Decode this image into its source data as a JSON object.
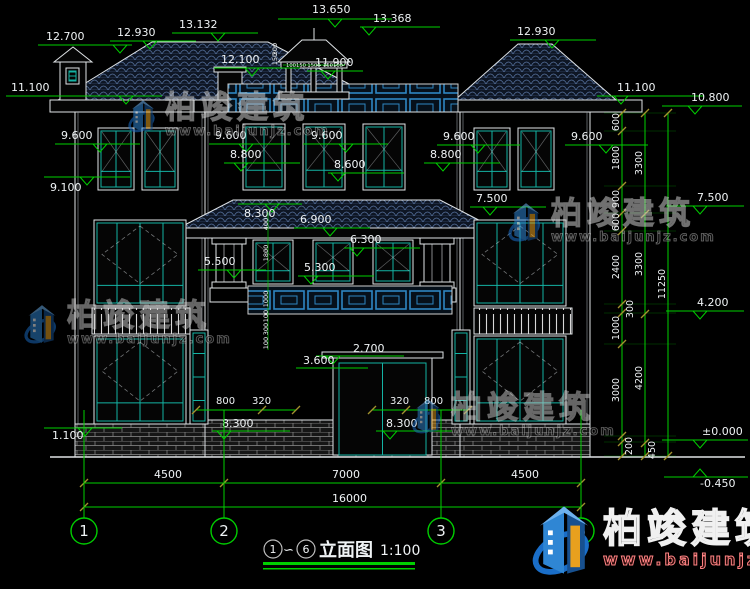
{
  "drawing": {
    "title_bar": {
      "axis_start": "1",
      "tilde": "∽",
      "axis_end": "6",
      "title": "立面图",
      "scale": "1:100"
    },
    "watermark": {
      "brand": "柏竣建筑",
      "url": "www.baijunjz.com"
    },
    "colors": {
      "green": "#00cf00",
      "olive": "#a3922e",
      "text": "#eff3f5",
      "teal": "#14b3a4",
      "blue": "#2e86c1",
      "line": "#dfe3e6",
      "logo_blue": "#1a6ec8",
      "logo_orange": "#e8a01e"
    },
    "elevation_markers": [
      [
        "12.700",
        46,
        40,
        38,
        132,
        45,
        120,
        1
      ],
      [
        "12.930",
        117,
        36,
        110,
        196,
        41,
        150,
        1
      ],
      [
        "13.132",
        179,
        28,
        172,
        258,
        33,
        218,
        1
      ],
      [
        "13.650",
        312,
        13,
        278,
        392,
        19,
        335,
        1
      ],
      [
        "13.368",
        373,
        22,
        360,
        440,
        27,
        369,
        1
      ],
      [
        "12.100",
        221,
        63,
        214,
        300,
        68,
        252,
        1
      ],
      [
        "11.900",
        315,
        66,
        307,
        363,
        71,
        328,
        1
      ],
      [
        "12.930",
        517,
        35,
        510,
        596,
        40,
        552,
        1
      ],
      [
        "11.100",
        11,
        91,
        6,
        162,
        96,
        126,
        1
      ],
      [
        "11.100",
        617,
        91,
        597,
        704,
        96,
        621,
        1
      ],
      [
        "10.800",
        691,
        101,
        662,
        742,
        106,
        695,
        1
      ],
      [
        "9.600",
        61,
        139,
        55,
        140,
        144,
        100,
        1
      ],
      [
        "9.600",
        215,
        139,
        209,
        290,
        144,
        246,
        1
      ],
      [
        "9.600",
        311,
        139,
        303,
        388,
        144,
        346,
        1
      ],
      [
        "9.600",
        443,
        140,
        437,
        520,
        145,
        478,
        1
      ],
      [
        "9.600",
        571,
        140,
        565,
        648,
        145,
        606,
        1
      ],
      [
        "8.800",
        230,
        158,
        224,
        300,
        163,
        241,
        1
      ],
      [
        "8.800",
        430,
        158,
        424,
        500,
        163,
        443,
        1
      ],
      [
        "8.600",
        334,
        168,
        328,
        404,
        173,
        338,
        1
      ],
      [
        "9.100",
        50,
        191,
        44,
        130,
        177,
        87,
        1
      ],
      [
        "7.500",
        476,
        202,
        470,
        546,
        207,
        490,
        1
      ],
      [
        "7.500",
        697,
        201,
        666,
        744,
        206,
        700,
        1
      ],
      [
        "8.300",
        244,
        217,
        238,
        302,
        204,
        272,
        1
      ],
      [
        "6.900",
        300,
        223,
        294,
        370,
        228,
        330,
        1
      ],
      [
        "6.300",
        350,
        243,
        344,
        420,
        248,
        357,
        1
      ],
      [
        "5.500",
        204,
        265,
        198,
        266,
        270,
        234,
        1
      ],
      [
        "5.300",
        304,
        271,
        298,
        374,
        276,
        311,
        1
      ],
      [
        "2.700",
        353,
        352,
        316,
        404,
        356,
        333,
        1
      ],
      [
        "3.600",
        303,
        364,
        296,
        368,
        368,
        0,
        0
      ],
      [
        "8.300",
        222,
        427,
        212,
        290,
        431,
        224,
        1
      ],
      [
        "8.300",
        386,
        427,
        376,
        452,
        431,
        390,
        1
      ],
      [
        "1.100",
        52,
        439,
        44,
        122,
        428,
        85,
        1
      ],
      [
        "4.200",
        697,
        306,
        666,
        744,
        311,
        700,
        1
      ],
      [
        "±0.000",
        702,
        435,
        662,
        748,
        440,
        700,
        1
      ],
      [
        "-0.450",
        700,
        487,
        664,
        748,
        477,
        700,
        2
      ]
    ],
    "windows": [
      [
        98,
        128,
        36,
        62,
        "t1"
      ],
      [
        142,
        128,
        36,
        62,
        "t1"
      ],
      [
        243,
        124,
        42,
        66,
        "t1"
      ],
      [
        303,
        124,
        42,
        66,
        "t1"
      ],
      [
        363,
        124,
        42,
        66,
        "t1"
      ],
      [
        474,
        128,
        36,
        62,
        "t1"
      ],
      [
        518,
        128,
        36,
        62,
        "t1"
      ],
      [
        94,
        220,
        92,
        86,
        "t2"
      ],
      [
        474,
        220,
        92,
        86,
        "t2"
      ],
      [
        253,
        240,
        40,
        44,
        "t3"
      ],
      [
        313,
        240,
        40,
        44,
        "t3"
      ],
      [
        373,
        240,
        40,
        44,
        "t3"
      ],
      [
        94,
        336,
        92,
        88,
        "t2"
      ],
      [
        474,
        336,
        92,
        88,
        "t2"
      ],
      [
        190,
        330,
        18,
        94,
        "t4"
      ],
      [
        452,
        330,
        18,
        94,
        "t4"
      ],
      [
        66,
        68,
        13,
        16,
        "t4"
      ],
      [
        333,
        358,
        99,
        97,
        "door"
      ]
    ],
    "right_dims": {
      "cols": [
        {
          "x": 622,
          "ticks": [
            113,
            131,
            186,
            213,
            231,
            304,
            313,
            344,
            436,
            442,
            456
          ],
          "labels": [
            [
              "600",
              122,
              0
            ],
            [
              "1800",
              158,
              0
            ],
            [
              "900",
              199,
              0
            ],
            [
              "600",
              222,
              0
            ],
            [
              "2400",
              267,
              0
            ],
            [
              "300",
              309,
              14
            ],
            [
              "1000",
              328,
              0
            ],
            [
              "3000",
              390,
              0
            ],
            [
              "200",
              446,
              13
            ]
          ]
        },
        {
          "x": 645,
          "ticks": [
            113,
            214,
            314,
            443,
            456
          ],
          "labels": [
            [
              "3300",
              163,
              0
            ],
            [
              "3300",
              264,
              0
            ],
            [
              "4200",
              378,
              0
            ],
            [
              "450",
              450,
              13
            ]
          ]
        },
        {
          "x": 668,
          "ticks": [
            113,
            456
          ],
          "labels": [
            [
              "11250",
              284,
              0
            ]
          ]
        }
      ]
    },
    "bottom_dims": {
      "lines": [
        {
          "y": 483,
          "x1": 84,
          "x2": 581,
          "ticks": [
            84,
            224,
            441,
            581
          ],
          "labels": [
            {
              "t": "4500",
              "x": 154
            },
            {
              "t": "7000",
              "x": 332
            },
            {
              "t": "4500",
              "x": 511
            }
          ]
        },
        {
          "y": 507,
          "x1": 84,
          "x2": 581,
          "ticks": [
            84,
            581
          ],
          "labels": [
            {
              "t": "16000",
              "x": 332
            }
          ]
        }
      ]
    },
    "door_dims": {
      "labels": [
        [
          "800",
          216,
          404
        ],
        [
          "320",
          252,
          404
        ],
        [
          "320",
          390,
          404
        ],
        [
          "800",
          424,
          404
        ]
      ],
      "lines": [
        [
          196,
          410,
          296,
          410
        ],
        [
          372,
          410,
          468,
          410
        ]
      ],
      "ticks": [
        [
          196,
          410
        ],
        [
          262,
          410
        ],
        [
          296,
          410
        ],
        [
          372,
          410
        ],
        [
          406,
          410
        ],
        [
          468,
          410
        ]
      ]
    },
    "mini_dims": {
      "rot": [
        [
          "400",
          268,
          224
        ],
        [
          "1800",
          268,
          253
        ],
        [
          "1000",
          268,
          299
        ],
        [
          "100",
          268,
          316
        ],
        [
          "300",
          268,
          329
        ],
        [
          "100",
          268,
          343
        ],
        [
          "300",
          277,
          49
        ],
        [
          "150",
          277,
          59
        ]
      ],
      "horiz": [
        [
          "100",
          291,
          67
        ],
        [
          "150",
          301,
          67
        ],
        [
          "1500",
          314,
          67
        ],
        [
          "150",
          328,
          67
        ],
        [
          "100",
          338,
          67
        ]
      ],
      "vline": [
        268,
        212,
        268,
        350
      ],
      "cupola_line": [
        283,
        65,
        345,
        65
      ]
    },
    "axis": {
      "y1": 410,
      "y2": 518,
      "cy": 531,
      "r": 13,
      "bubbles": [
        [
          "1",
          84
        ],
        [
          "2",
          224
        ],
        [
          "3",
          441
        ],
        [
          "6",
          581
        ]
      ]
    }
  }
}
